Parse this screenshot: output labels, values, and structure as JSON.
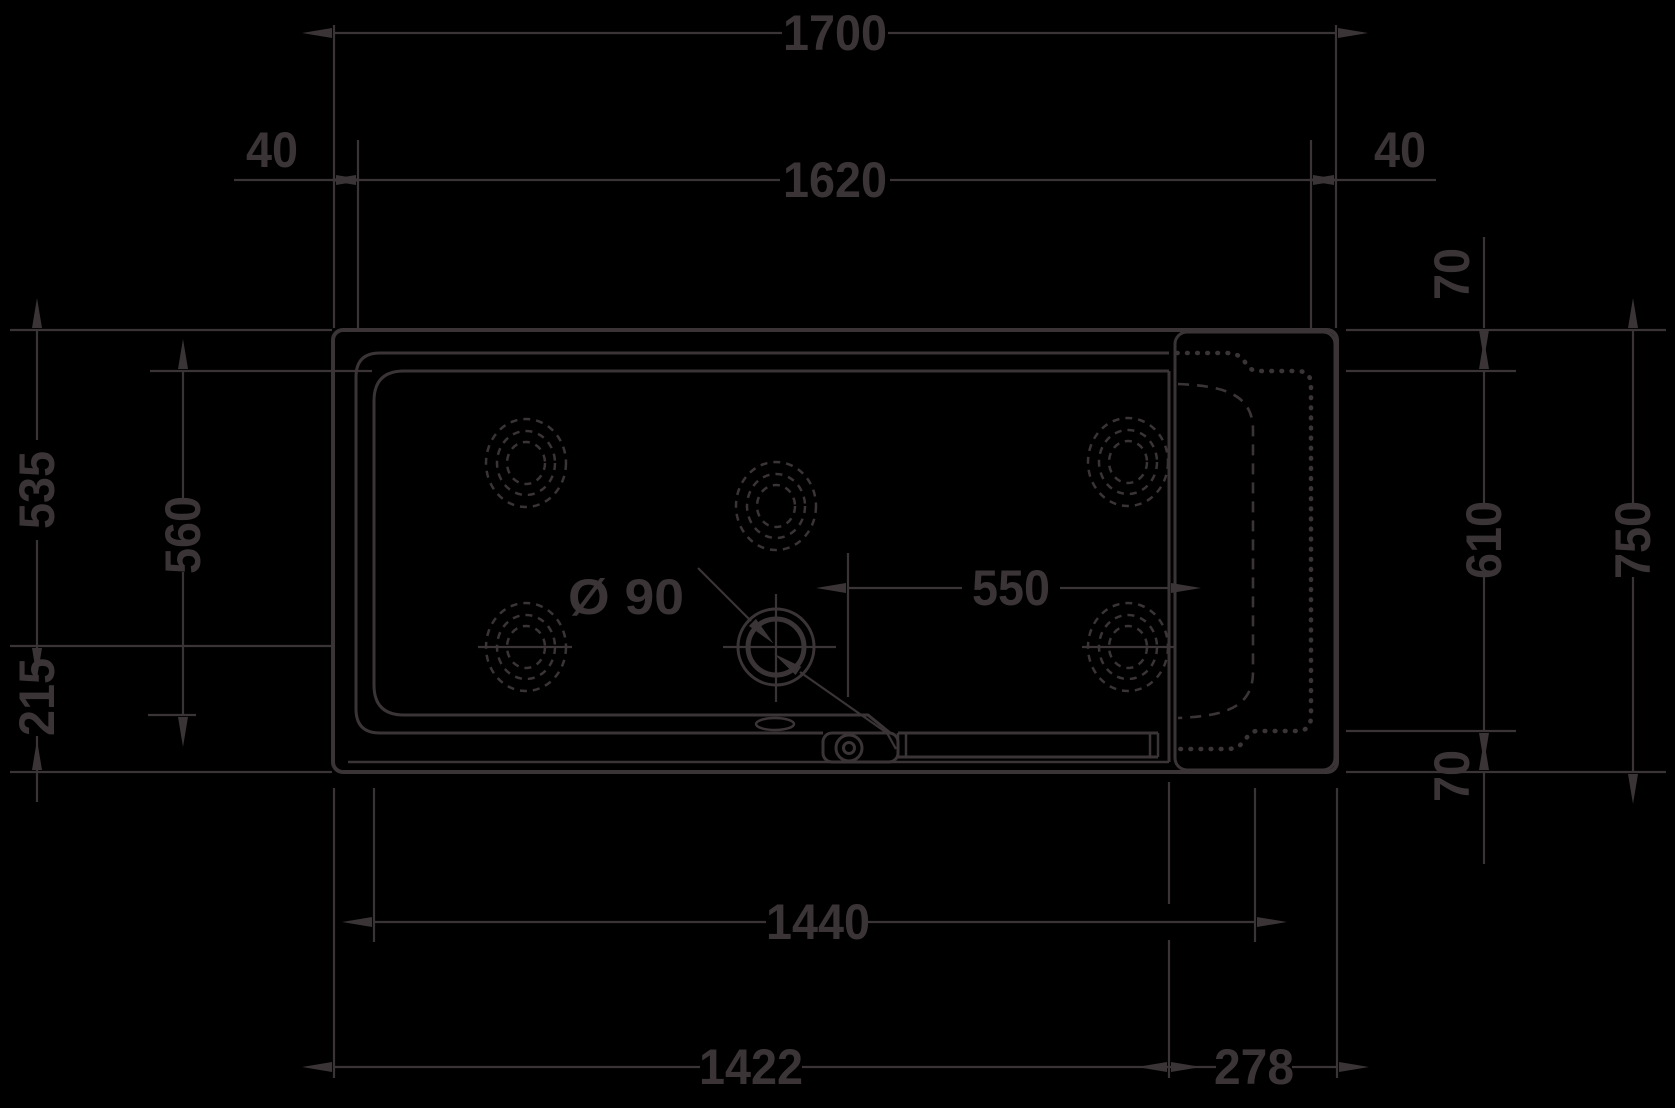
{
  "canvas": {
    "background": "#000000",
    "line_color": "#3a3436"
  },
  "drawing": {
    "type": "technical-drawing",
    "subject": "bathtub plan view with whirl jets, drain and seat section",
    "dims": {
      "top_overall": "1700",
      "top_left_offset": "40",
      "top_inner": "1620",
      "top_right_offset": "40",
      "right_top_gap": "70",
      "left_upper": "535",
      "left_inner": "560",
      "left_lower": "215",
      "right_inner": "610",
      "right_overall": "750",
      "drain_diameter": "Ø 90",
      "drain_offset": "550",
      "right_bottom_gap": "70",
      "bottom_inner": "1440",
      "bottom_left_section": "1422",
      "bottom_right_section": "278"
    }
  }
}
